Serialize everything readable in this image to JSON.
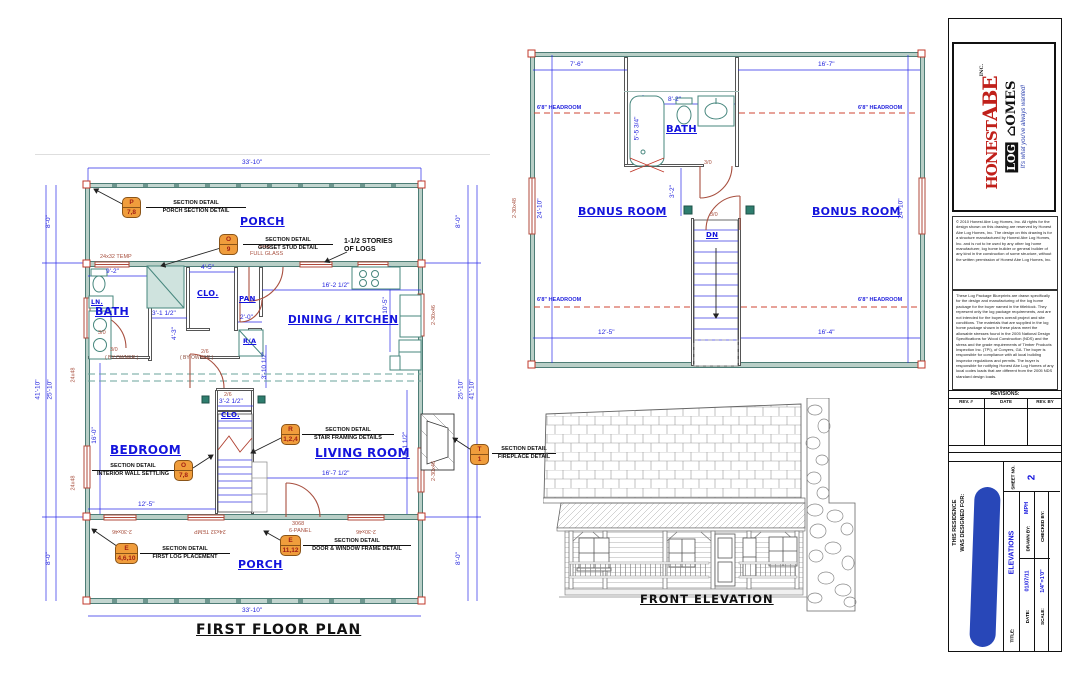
{
  "first_floor": {
    "title": "FIRST FLOOR PLAN",
    "rooms": {
      "porch": "PORCH",
      "bath": "BATH",
      "clo": "CLO.",
      "pan": "PAN",
      "dining_kitchen": "DINING / KITCHEN",
      "bedroom": "BEDROOM",
      "living": "LIVING ROOM",
      "ra": "R/A",
      "ln": "LN."
    },
    "note_stories_1": "1-1/2 STORIES",
    "note_stories_2": "OF LOGS",
    "by_owner": "( BY OWNER )",
    "dims": {
      "w3310": "33'-10\"",
      "h4110": "41'-10\"",
      "h2510": "25'-10\"",
      "h80": "8'-0\"",
      "d92": "9'-2\"",
      "d45": "4'-5\"",
      "d16212": "16'-2 1/2\"",
      "d105": "10'-5\"",
      "d3112": "3'-1 1/2\"",
      "d43": "4'-3\"",
      "d20": "2'-0\"",
      "d31012": "3'-10 1/2\"",
      "d3212": "3'-2 1/2\"",
      "d160": "16'-0\"",
      "d125": "12'-5\"",
      "d16712": "16'-7 1/2\"",
      "d14112": "14'-1 1/2\""
    },
    "tags": {
      "w2432": "24x32 TEMP",
      "w2448": "24x48",
      "w23046": "2-30x46",
      "d3068": "3068",
      "fullglass": "FULL GLASS",
      "panel6": "6-PANEL",
      "d30": "3/0",
      "d26": "2/6"
    },
    "details": {
      "p": {
        "letter": "P",
        "nums": "7,8",
        "l1": "SECTION DETAIL",
        "l2": "PORCH SECTION DETAIL"
      },
      "o9": {
        "letter": "O",
        "nums": "9",
        "l1": "SECTION DETAIL",
        "l2": "GUSSET STUD DETAIL"
      },
      "o78": {
        "letter": "O",
        "nums": "7,8",
        "l1": "SECTION DETAIL",
        "l2": "INTERIOR WALL SETTLING"
      },
      "r124": {
        "letter": "R",
        "nums": "1,2,4",
        "l1": "SECTION DETAIL",
        "l2": "STAIR FRAMING DETAILS"
      },
      "e46": {
        "letter": "E",
        "nums": "4,6,10",
        "l1": "SECTION DETAIL",
        "l2": "FIRST LOG PLACEMENT"
      },
      "e1112": {
        "letter": "E",
        "nums": "11,12",
        "l1": "SECTION DETAIL",
        "l2": "DOOR & WINDOW FRAME DETAIL"
      },
      "t1": {
        "letter": "T",
        "nums": "1",
        "l1": "SECTION DETAIL",
        "l2": "FIREPLACE DETAIL"
      }
    }
  },
  "second_floor": {
    "rooms": {
      "bonus": "BONUS ROOM",
      "bath": "BATH",
      "dn": "DN"
    },
    "headroom": "6'8\" HEADROOM",
    "dims": {
      "d76": "7'-6\"",
      "d167": "16'-7\"",
      "d82": "8'-2\"",
      "d5534": "5'-5 3/4\"",
      "d32": "3'-2\"",
      "d2410": "24'-10\"",
      "d125": "12'-5\"",
      "d164": "16'-4\""
    },
    "tags": {
      "w23048": "2-30x48",
      "d30": "3/0"
    }
  },
  "elevation": {
    "title": "FRONT ELEVATION"
  },
  "titleblock": {
    "logo": {
      "brand1": "HONEST",
      "brand2": "ABE",
      "inc": "INC.",
      "log": "LOG",
      "homes": "OMES",
      "tagline": "It's what you've always wanted!"
    },
    "legal1": "© 2010 Honest Abe Log Homes, Inc. All rights for the design shown on this drawing are reserved by Honest Abe Log Homes, Inc. The design on this drawing is for a structure manufactured by Honest Abe Log Homes, Inc. and is not to be used by any other log home manufacturer, log home builder or general builder of any kind in the construction of some structure, without the written permission of Honest Abe Log Homes, Inc.",
    "legal2": "These Log Package Blueprints are drawn specifically for the design and manufacturing of the log home package for the buyer named in the titleblock. They represent only the log package requirements, and are not intended for the buyers overall project and site conditions. The materials that are supplied in the log home package shown in these plans meet the allowable stresses found in the 2005 National Design Specifications for Wood Construction (NDS) and the stress and the grade requirements of Timber Products Inspection Inc. (TPI), of Conyers, GA. The buyer is responsible for compliance with all local building inspector regulations and permits. The buyer is responsible for notifying Honest Abe Log Homes of any local codes loads that are different from the 2005 NDS standard design loads.",
    "revisions": {
      "title": "REVISIONS:",
      "rev": "REV. #",
      "date": "DATE",
      "by": "REV. BY"
    },
    "designed1": "THIS RESIDENCE",
    "designed2": "WAS DESIGNED FOR:",
    "title_label": "TITLE:",
    "title_value": "ELEVATIONS",
    "date_label": "DATE:",
    "date_value": "01/07/11",
    "scale_label": "SCALE:",
    "scale_value": "1/4\"=1'0\"",
    "drawn_label": "DRAWN BY:",
    "drawn_value": "MPH",
    "checked_label": "CHECKED BY:",
    "sheet_label": "SHEET NO.",
    "sheet_value": "2"
  }
}
